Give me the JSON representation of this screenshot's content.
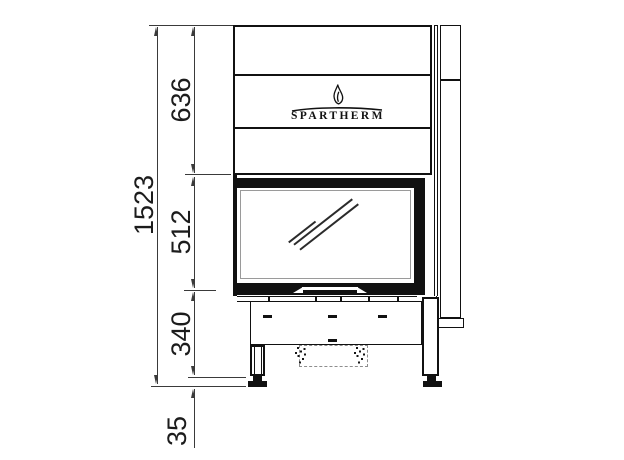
{
  "drawing": {
    "type": "technical-dimension-drawing",
    "brand_logo": {
      "name": "SPARTHERM"
    },
    "dimensions": {
      "total_height": "1523",
      "upper_section": "636",
      "glass_door": "512",
      "base_section": "340",
      "foot_clearance": "35"
    }
  },
  "colors": {
    "line": "#111111",
    "dim_line": "#3a3a3a",
    "background": "#ffffff"
  }
}
